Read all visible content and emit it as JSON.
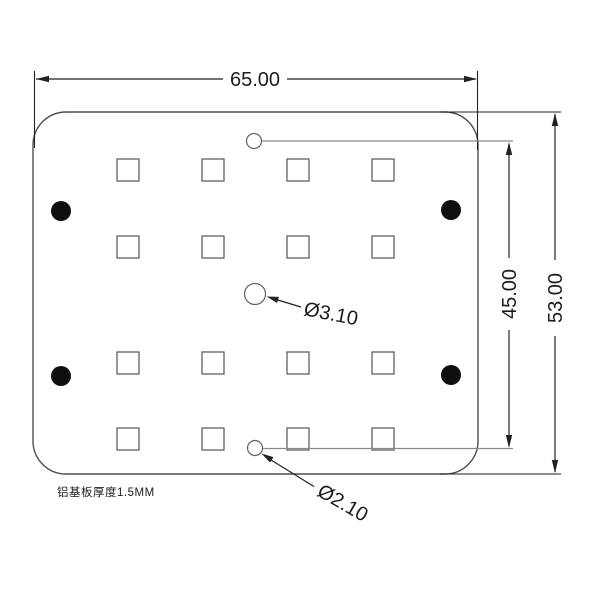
{
  "drawing": {
    "dims": {
      "width": "65.00",
      "inner_height": "45.00",
      "outer_height": "53.00",
      "center_hole": "Ø3.10",
      "edge_hole": "Ø2.10"
    },
    "note": "铝基板厚度1.5MM",
    "pad_grid": {
      "rows": 4,
      "cols": 4,
      "count": 16
    },
    "mounting_hole_count": 4,
    "small_hole_count": 2
  },
  "colors": {
    "background": "#ffffff",
    "dim_line": "#222222",
    "outline": "#4f4f4f",
    "pad_stroke": "#616161",
    "hole_fill": "#0f0f0f",
    "ext_gray": "#8a8a8a",
    "text": "#1c1c1c"
  }
}
